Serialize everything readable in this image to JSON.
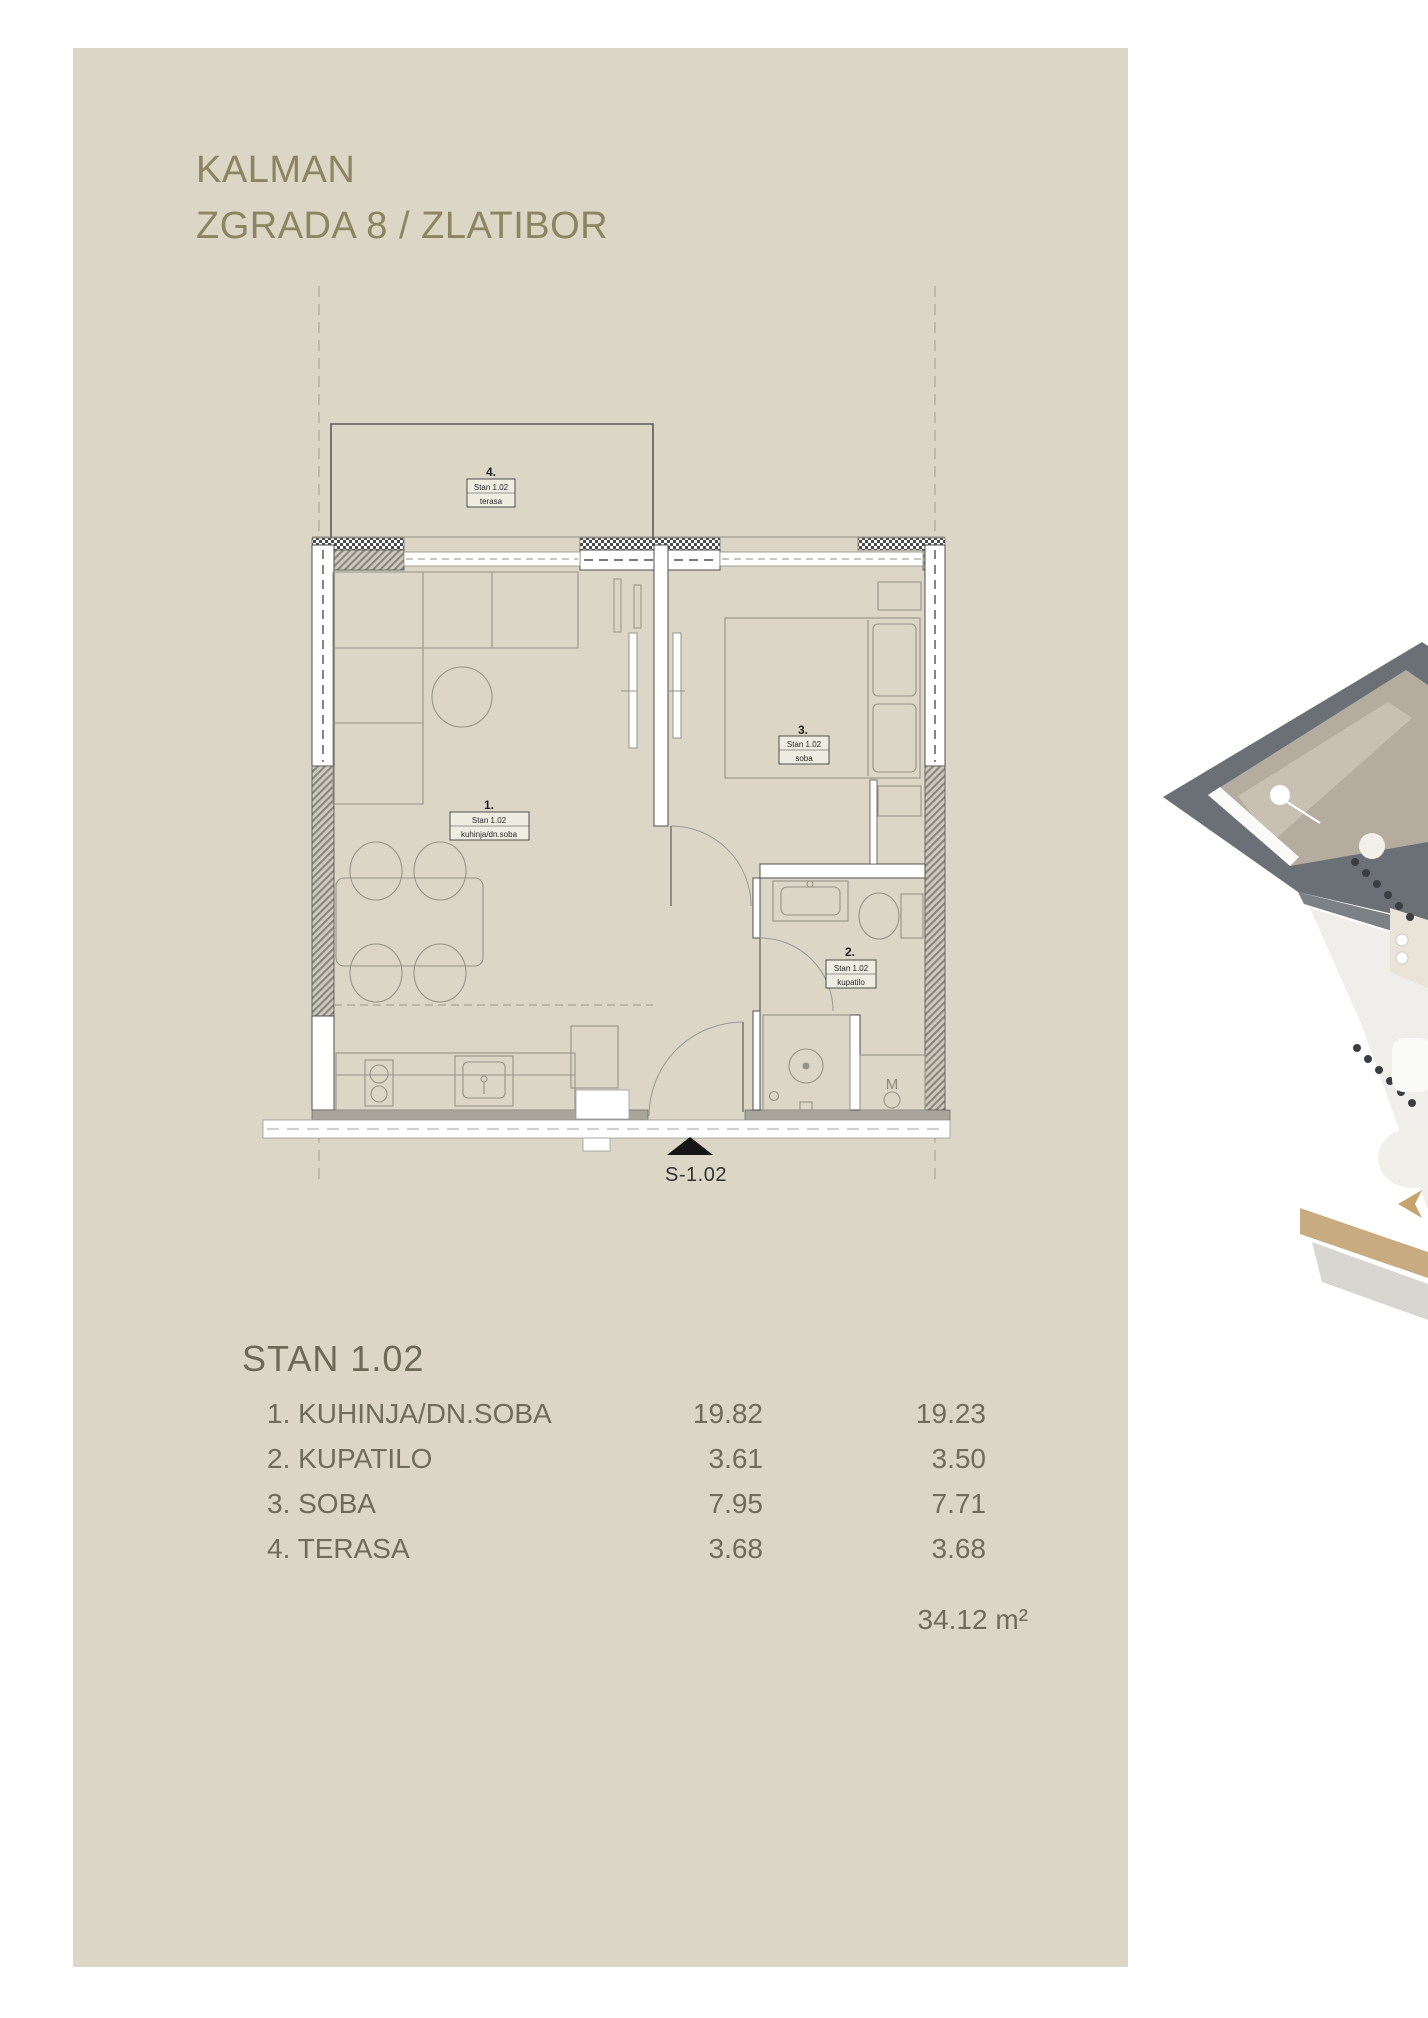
{
  "header": {
    "title_line1": "KALMAN",
    "title_line2": "ZGRADA 8 / ZLATIBOR"
  },
  "floor_plan": {
    "labels": {
      "terasa": {
        "number": "4.",
        "unit": "Stan 1.02",
        "name": "terasa"
      },
      "kuhinja": {
        "number": "1.",
        "unit": "Stan 1.02",
        "name": "kuhinja/dn.soba"
      },
      "soba": {
        "number": "3.",
        "unit": "Stan 1.02",
        "name": "soba"
      },
      "kupatilo": {
        "number": "2.",
        "unit": "Stan 1.02",
        "name": "kupatilo"
      }
    },
    "entrance_marker": "S-1.02",
    "washing_machine_label": "M"
  },
  "unit_summary": {
    "title": "STAN 1.02",
    "rows": [
      {
        "label": "1. KUHINJA/DN.SOBA",
        "area": "19.82",
        "area_reduced": "19.23"
      },
      {
        "label": "2. KUPATILO",
        "area": "3.61",
        "area_reduced": "3.50"
      },
      {
        "label": "3. SOBA",
        "area": "7.95",
        "area_reduced": "7.71"
      },
      {
        "label": "4. TERASA",
        "area": "3.68",
        "area_reduced": "3.68"
      }
    ],
    "total_area": "34.12 m²"
  },
  "colors": {
    "panel": "#dbd6c5",
    "title_text": "#8c855f",
    "table_text": "#706c5c"
  }
}
